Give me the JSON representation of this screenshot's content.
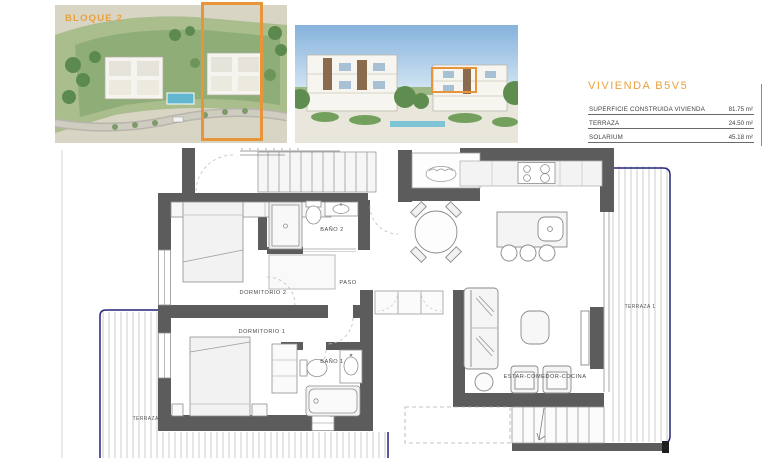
{
  "header": {
    "site_image": {
      "label": "BLOQUE 2"
    },
    "unit": {
      "title": "VIVIENDA B5V5",
      "specs": [
        {
          "label": "SUPERFICIE CONSTRUIDA VIVIENDA",
          "value": "81.75 m²"
        },
        {
          "label": "TERRAZA",
          "value": "24.50 m²"
        },
        {
          "label": "SOLARIUM",
          "value": "45.18 m²"
        }
      ]
    }
  },
  "floorplan": {
    "rooms": [
      {
        "name": "DORMITORIO 2"
      },
      {
        "name": "BAÑO 2"
      },
      {
        "name": "PASO"
      },
      {
        "name": "DORMITORIO 1"
      },
      {
        "name": "BAÑO 1"
      },
      {
        "name": "ESTAR-COMEDOR-COCINA"
      },
      {
        "name": "TERRAZA 1"
      },
      {
        "name": "TERRAZA 2"
      }
    ]
  },
  "colors": {
    "accent_orange": "#E8953A",
    "title_orange": "#E8A13C",
    "wall_gray": "#5C5C5C",
    "balustrade_navy": "#23237A",
    "hatch_gray": "#C9C9C9"
  }
}
